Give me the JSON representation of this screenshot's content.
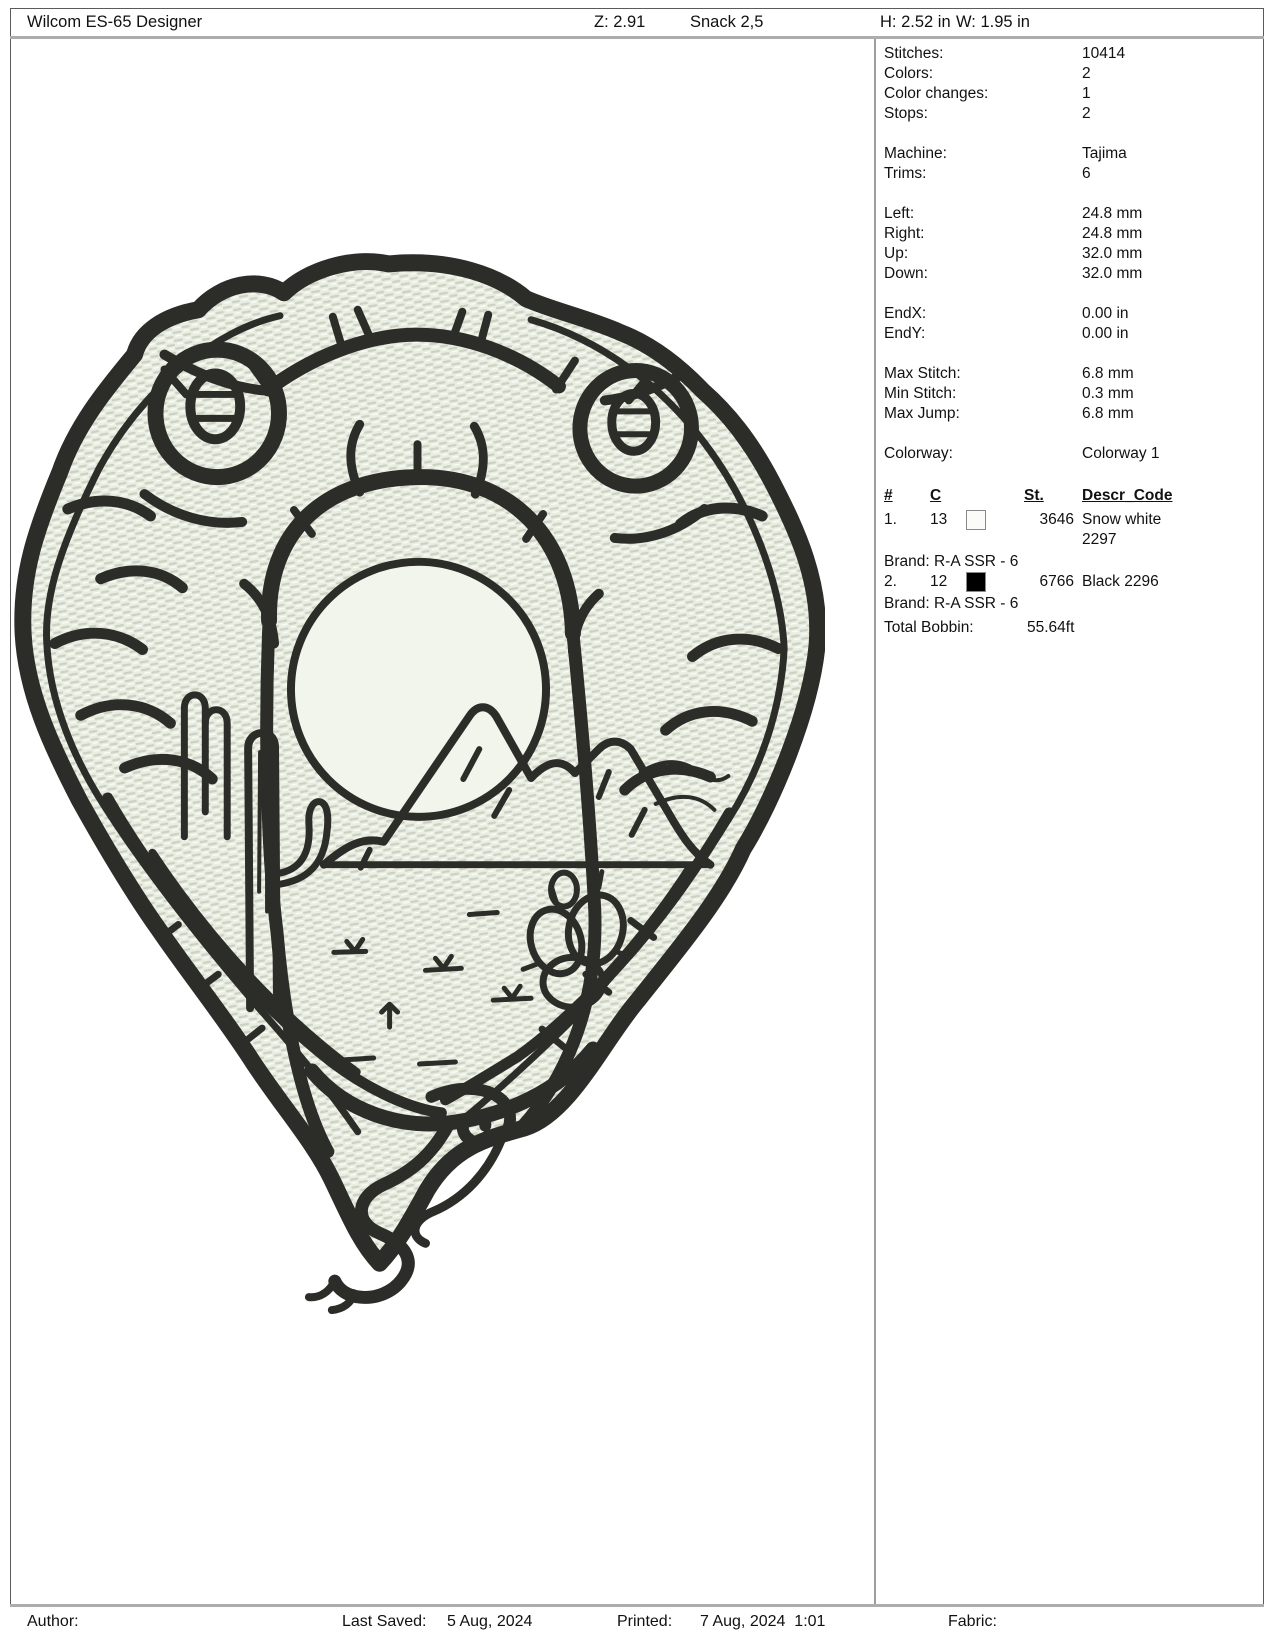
{
  "header": {
    "app_title": "Wilcom ES-65 Designer",
    "zoom": "Z: 2.91",
    "design_name": "Snack 2,5",
    "height": "H: 2.52 in",
    "width": "W: 1.95 in"
  },
  "stats": [
    {
      "label": "Stitches:",
      "value": "10414"
    },
    {
      "label": "Colors:",
      "value": "2"
    },
    {
      "label": "Color changes:",
      "value": "1"
    },
    {
      "label": "Stops:",
      "value": "2"
    },
    {
      "label": "Machine:",
      "value": "Tajima"
    },
    {
      "label": "Trims:",
      "value": "6"
    },
    {
      "label": "Left:",
      "value": "24.8 mm"
    },
    {
      "label": "Right:",
      "value": "24.8 mm"
    },
    {
      "label": "Up:",
      "value": "32.0 mm"
    },
    {
      "label": "Down:",
      "value": "32.0 mm"
    },
    {
      "label": "EndX:",
      "value": "0.00 in"
    },
    {
      "label": "EndY:",
      "value": "0.00 in"
    },
    {
      "label": "Max Stitch:",
      "value": "6.8 mm"
    },
    {
      "label": "Min Stitch:",
      "value": "0.3 mm"
    },
    {
      "label": "Max Jump:",
      "value": "6.8 mm"
    },
    {
      "label": "Colorway:",
      "value": "Colorway 1"
    }
  ],
  "color_table": {
    "headers": [
      "#",
      "C",
      "St.",
      "Descr_Code"
    ],
    "rows": [
      {
        "num": "1.",
        "c": "13",
        "swatch": "#fbfbf9",
        "st": "3646",
        "descr": "Snow white 2297",
        "brand": "Brand: R-A SSR - 6"
      },
      {
        "num": "2.",
        "c": "12",
        "swatch": "#000000",
        "st": "6766",
        "descr": "Black 2296",
        "brand": "Brand: R-A SSR - 6"
      }
    ],
    "total_label": "Total Bobbin:",
    "total_value": "55.64ft"
  },
  "footer": {
    "author_label": "Author:",
    "last_saved_label": "Last Saved:",
    "last_saved_value": "5 Aug, 2024",
    "printed_label": "Printed:",
    "printed_value": "7 Aug, 2024  1:01",
    "fabric_label": "Fabric:"
  },
  "design": {
    "description": "Snake head embroidery patch with desert scene: sun, mountains, saguaro cactus, prickly pear, and rattlesnake tail",
    "colors": {
      "thread_dark": "#2c2c28",
      "patch_base": "#e9ede2",
      "patch_texture": "#cbd2c1",
      "patch_highlight": "#fafcf7",
      "sun_fill": "#f2f5ec"
    }
  }
}
